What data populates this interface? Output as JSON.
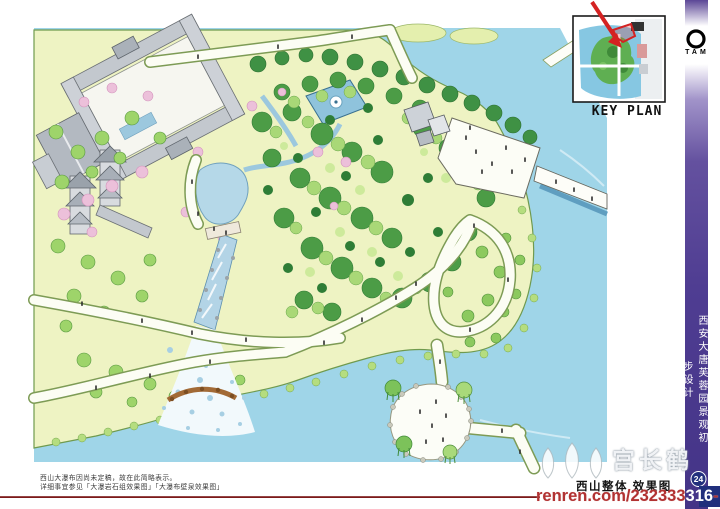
{
  "key_plan": {
    "label": "KEY PLAN"
  },
  "logo": {
    "text": "TAM"
  },
  "sidebar": {
    "title": "西安大唐芙蓉园景观初步设计",
    "page_number": "24"
  },
  "notes": {
    "line1": "西山大瀑布因尚未定稿，故在此简略表示。",
    "line2": "详细事宜参见「大瀑岩石组效果图」「大瀑布壁泉效果图」"
  },
  "footer": {
    "drawing_title": "西山整体 效果图"
  },
  "watermark": {
    "brand": "宫长鹤",
    "url_prefix": "renren.com/232333",
    "url_highlight": "316",
    "url_suffix": "-"
  },
  "colors": {
    "accent_purple": "#4f3d92",
    "water": "#9fd5e8",
    "land": "#eef3c3",
    "red_line": "#7c1a1a",
    "arrow_red": "#d42222",
    "badge_navy": "#23307d"
  }
}
